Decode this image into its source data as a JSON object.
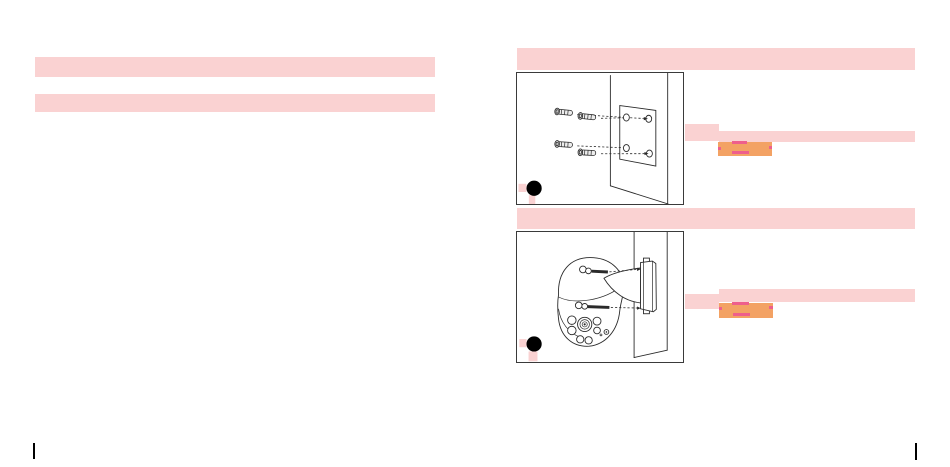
{
  "page": {
    "kind": "scanned-installation-manual-page",
    "background": "#ffffff"
  },
  "colors": {
    "redaction_pink": "#fad2d2",
    "redaction_orange": "#f3a264",
    "redaction_accent": "#ee5f8c",
    "figure_border": "#3a3a3a",
    "line_art": "#2a2a2a",
    "marker_black": "#000000"
  },
  "left_column": {
    "heading_bar_text": "",
    "subheading_bar_text": ""
  },
  "right_column": {
    "step1": {
      "title_bar_text": "",
      "figure": {
        "name": "wall-plugs-aligned-to-mounting-plate-holes",
        "marker": "black-step-dot"
      },
      "caption": {
        "lead_text": "",
        "line_text": "",
        "highlight_text": ""
      }
    },
    "step2": {
      "title_bar_text": "",
      "figure": {
        "name": "dome-camera-screwed-to-wall-bracket",
        "marker": "black-step-dot"
      },
      "caption": {
        "lead_text": "",
        "line_text": "",
        "highlight_text": ""
      }
    }
  },
  "print_marks": {
    "left": "crop-tick",
    "right": "crop-tick"
  }
}
